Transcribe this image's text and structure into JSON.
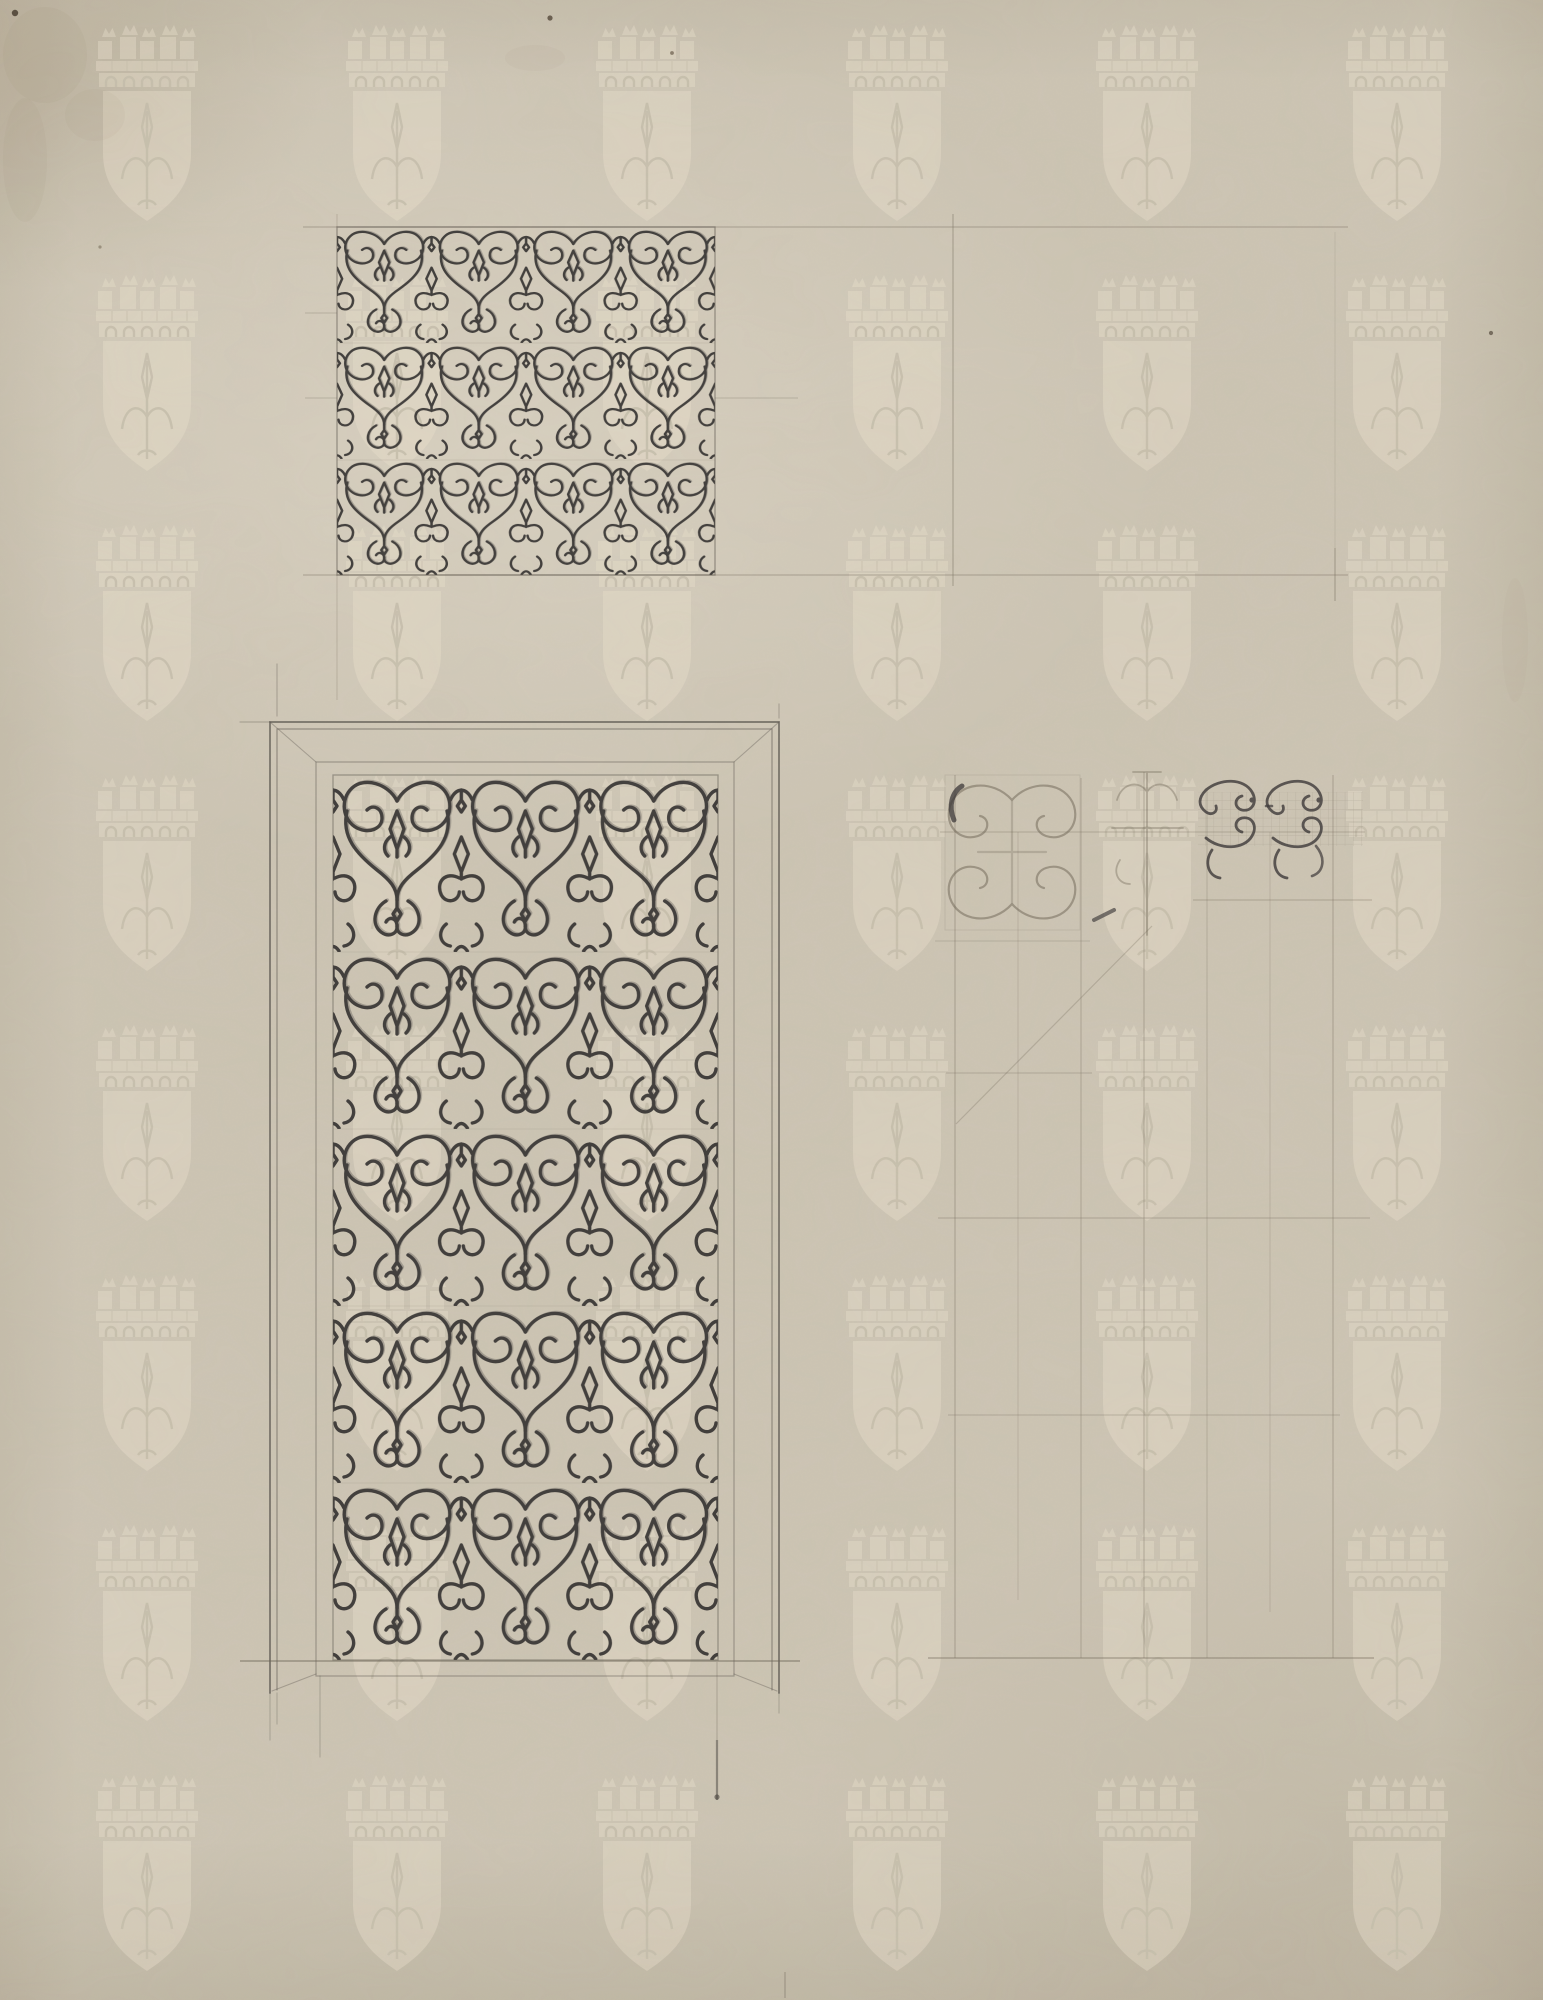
{
  "artwork": {
    "medium": "ink and pencil drawing on aged paper",
    "subject": "ornamental wrought-iron scrollwork grille studies",
    "elements": {
      "square_panel": "square scrollwork panel study",
      "door_panel": "tall door grille panel in moulded frame",
      "layout_rectangle": "empty ruled rectangle, upper right",
      "layout_grid": "faint pencil layout grid with scroll sketch fragments",
      "watermark": "mural crown shield watermark"
    }
  },
  "watermark": {
    "icon": "mural-crown-shield-watermark-icon",
    "columns": 6,
    "rows": 8
  },
  "colors": {
    "paper": "#cdc5b4",
    "paper_detail": "#c6beac",
    "ink": "#33302f",
    "pencil": "#7d7463",
    "sketch": "#6e6555",
    "sketch_dark": "#3e3a3a",
    "watermark_light": "#eae2cd"
  }
}
